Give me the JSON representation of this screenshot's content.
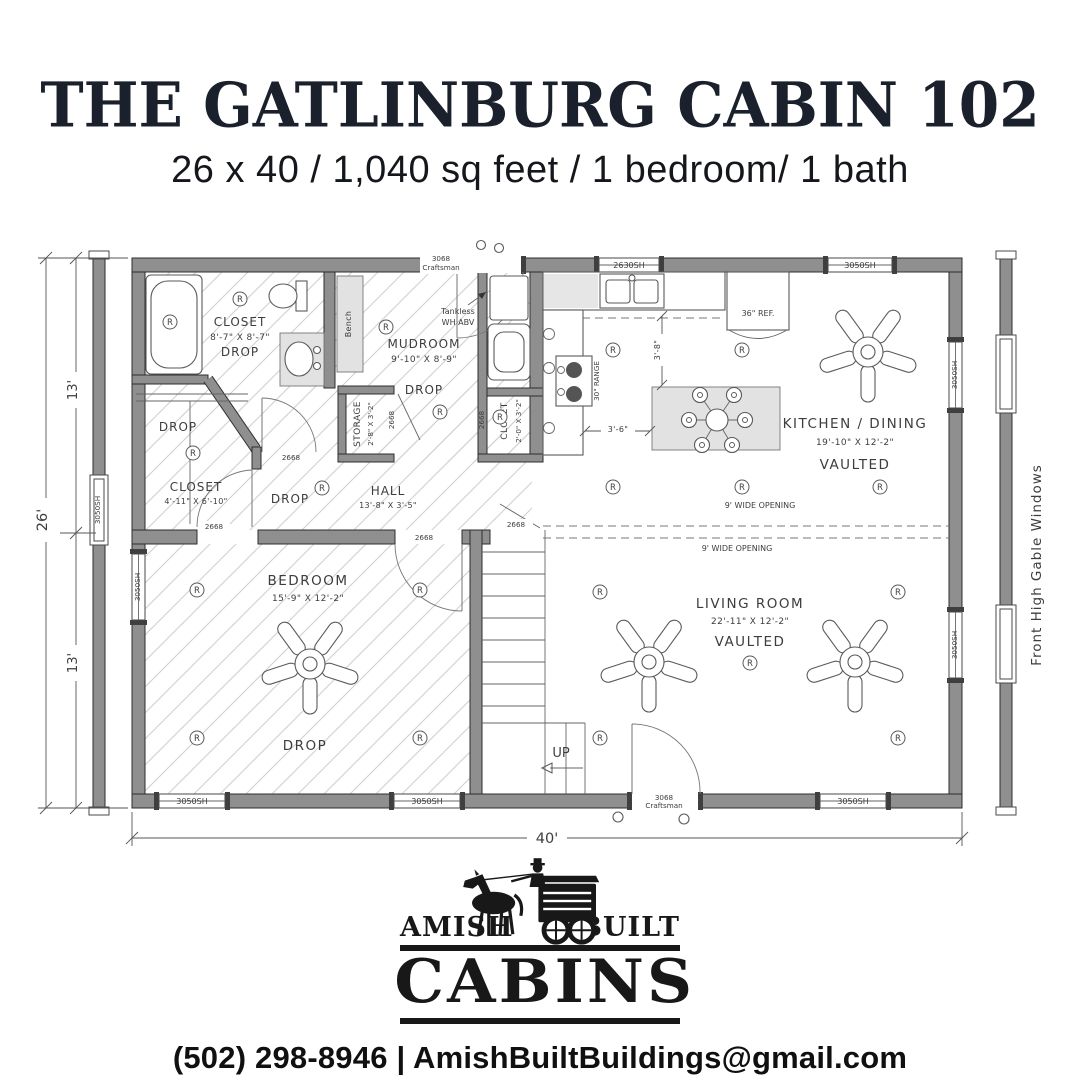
{
  "header": {
    "title": "THE GATLINBURG CABIN 102",
    "subtitle": "26 x 40 / 1,040 sq feet / 1 bedroom/ 1 bath"
  },
  "plan": {
    "dims": {
      "overall_width": "40'",
      "overall_height": "26'",
      "top_half": "13'",
      "bottom_half": "13'",
      "island_clearance": "3'-6\"",
      "counter_clearance": "3'-8\""
    },
    "side_label": "Front High Gable Windows",
    "rooms": {
      "bath_closet": {
        "name": "CLOSET",
        "size": "8'-7\" X 8'-7\"",
        "ceiling": "DROP"
      },
      "mudroom": {
        "name": "MUDROOM",
        "size": "9'-10\" X 8'-9\"",
        "ceiling": "DROP"
      },
      "storage": {
        "name": "STORAGE",
        "size": "2'-8\" X 3'-2\""
      },
      "small_closet": {
        "name": "CLOSET",
        "size": "2'-0\" X 3'-2\""
      },
      "bedroom_closet": {
        "name": "CLOSET",
        "size": "4'-11\" X 6'-10\"",
        "ceiling": "DROP"
      },
      "hall": {
        "name": "HALL",
        "size": "13'-8\" X 3'-5\"",
        "ceiling": "DROP"
      },
      "kitchen_dining": {
        "name": "KITCHEN / DINING",
        "size": "19'-10\" X 12'-2\"",
        "ceiling": "VAULTED"
      },
      "bedroom": {
        "name": "BEDROOM",
        "size": "15'-9\" X 12'-2\"",
        "ceiling": "DROP"
      },
      "living_room": {
        "name": "LIVING ROOM",
        "size": "22'-11\" X 12'-2\"",
        "ceiling": "VAULTED"
      }
    },
    "labels": {
      "bench": "Bench",
      "fridge": "36\" REF.",
      "range": "30\" RANGE",
      "tankless_line1": "Tankless",
      "tankless_line2": "WH ABV",
      "up": "UP",
      "wide_opening": "9' WIDE OPENING",
      "recessed_light": "R"
    },
    "openings": {
      "window_2630": "2630SH",
      "window_3050": "3050SH",
      "door_2668": "2668",
      "door_3068_line1": "3068",
      "door_3068_line2": "Craftsman"
    }
  },
  "logo": {
    "tagline_left": "AMISH",
    "tagline_right": "BUILT",
    "name": "CABINS"
  },
  "footer": {
    "contact": "(502) 298-8946 | AmishBuiltBuildings@gmail.com"
  }
}
